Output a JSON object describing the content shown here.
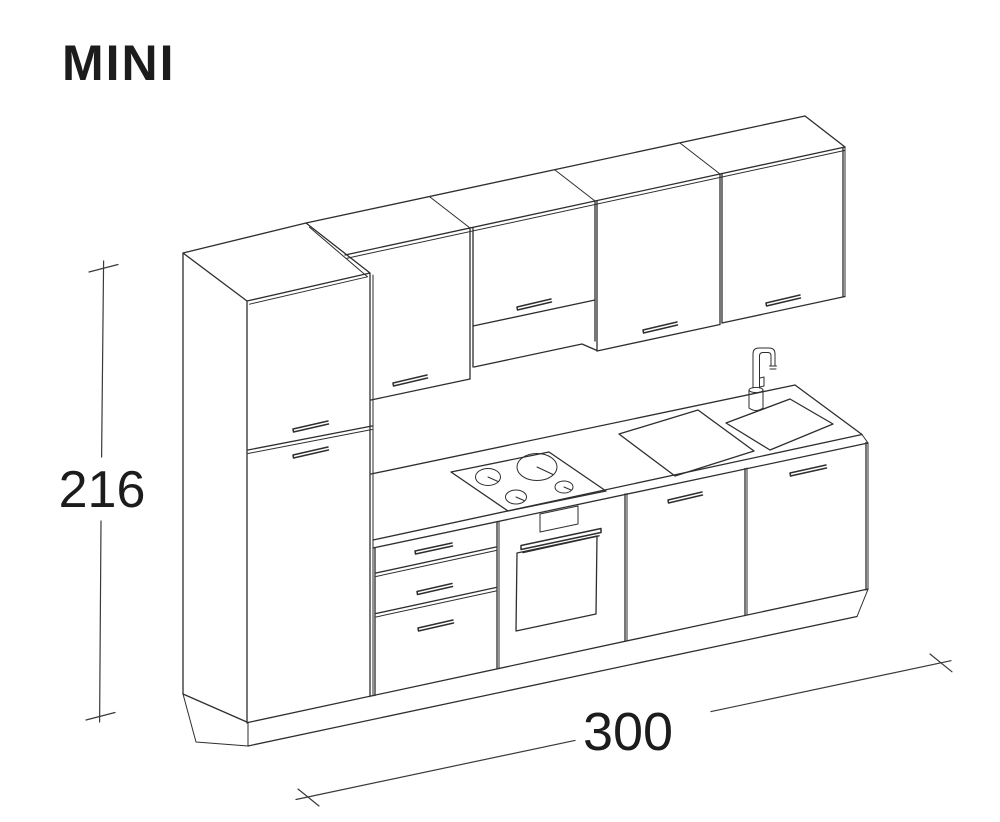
{
  "title": {
    "text": "MINI"
  },
  "dimensions": {
    "height": {
      "value": "216"
    },
    "width": {
      "value": "300"
    }
  },
  "colors": {
    "line": "#2e2e2e",
    "text": "#1c1c1c",
    "background": "#ffffff"
  }
}
